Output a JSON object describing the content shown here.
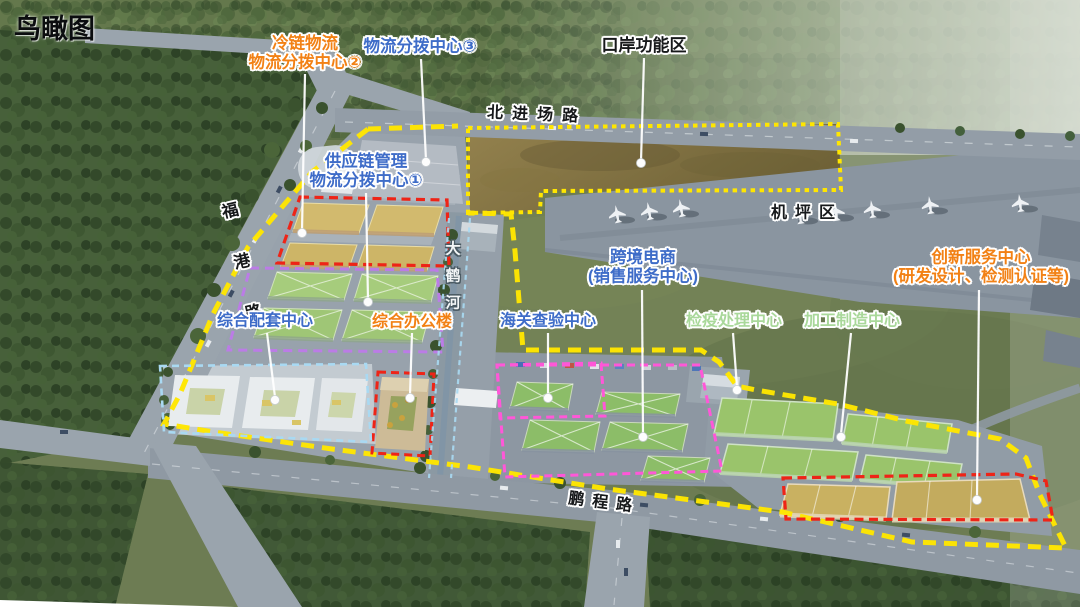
{
  "view": {
    "caption": "鸟瞰图"
  },
  "labels": {
    "title": "鸟瞰图",
    "cold_chain": "冷链物流\n物流分拨中心②",
    "dispatch3": "物流分拨中心③",
    "port_zone": "口岸功能区",
    "supply_chain": "供应链管理\n物流分拨中心①",
    "support_center": "综合配套中心",
    "office_building": "综合办公楼",
    "customs": "海关查验中心",
    "cross_border": "跨境电商\n(销售服务中心)",
    "quarantine": "检疫处理中心",
    "processing": "加工制造中心",
    "innovation": "创新服务中心\n(研发设计、检测认证等)",
    "apron": "机坪区"
  },
  "roads": {
    "north_entry": "北进场路",
    "fugang": "福\n港\n路",
    "pengcheng": "鹏程路",
    "river": "大\n鹤\n河"
  },
  "colors": {
    "accent_orange": "#f28115",
    "accent_blue": "#3e6cc8",
    "accent_green": "#a9d89a",
    "boundary_yellow": "#ffe600",
    "dash_red": "#ee2417",
    "dash_magenta": "#ff57d8",
    "dash_violet": "#bb7ce6",
    "dash_lightblue": "#a9d9f2"
  }
}
